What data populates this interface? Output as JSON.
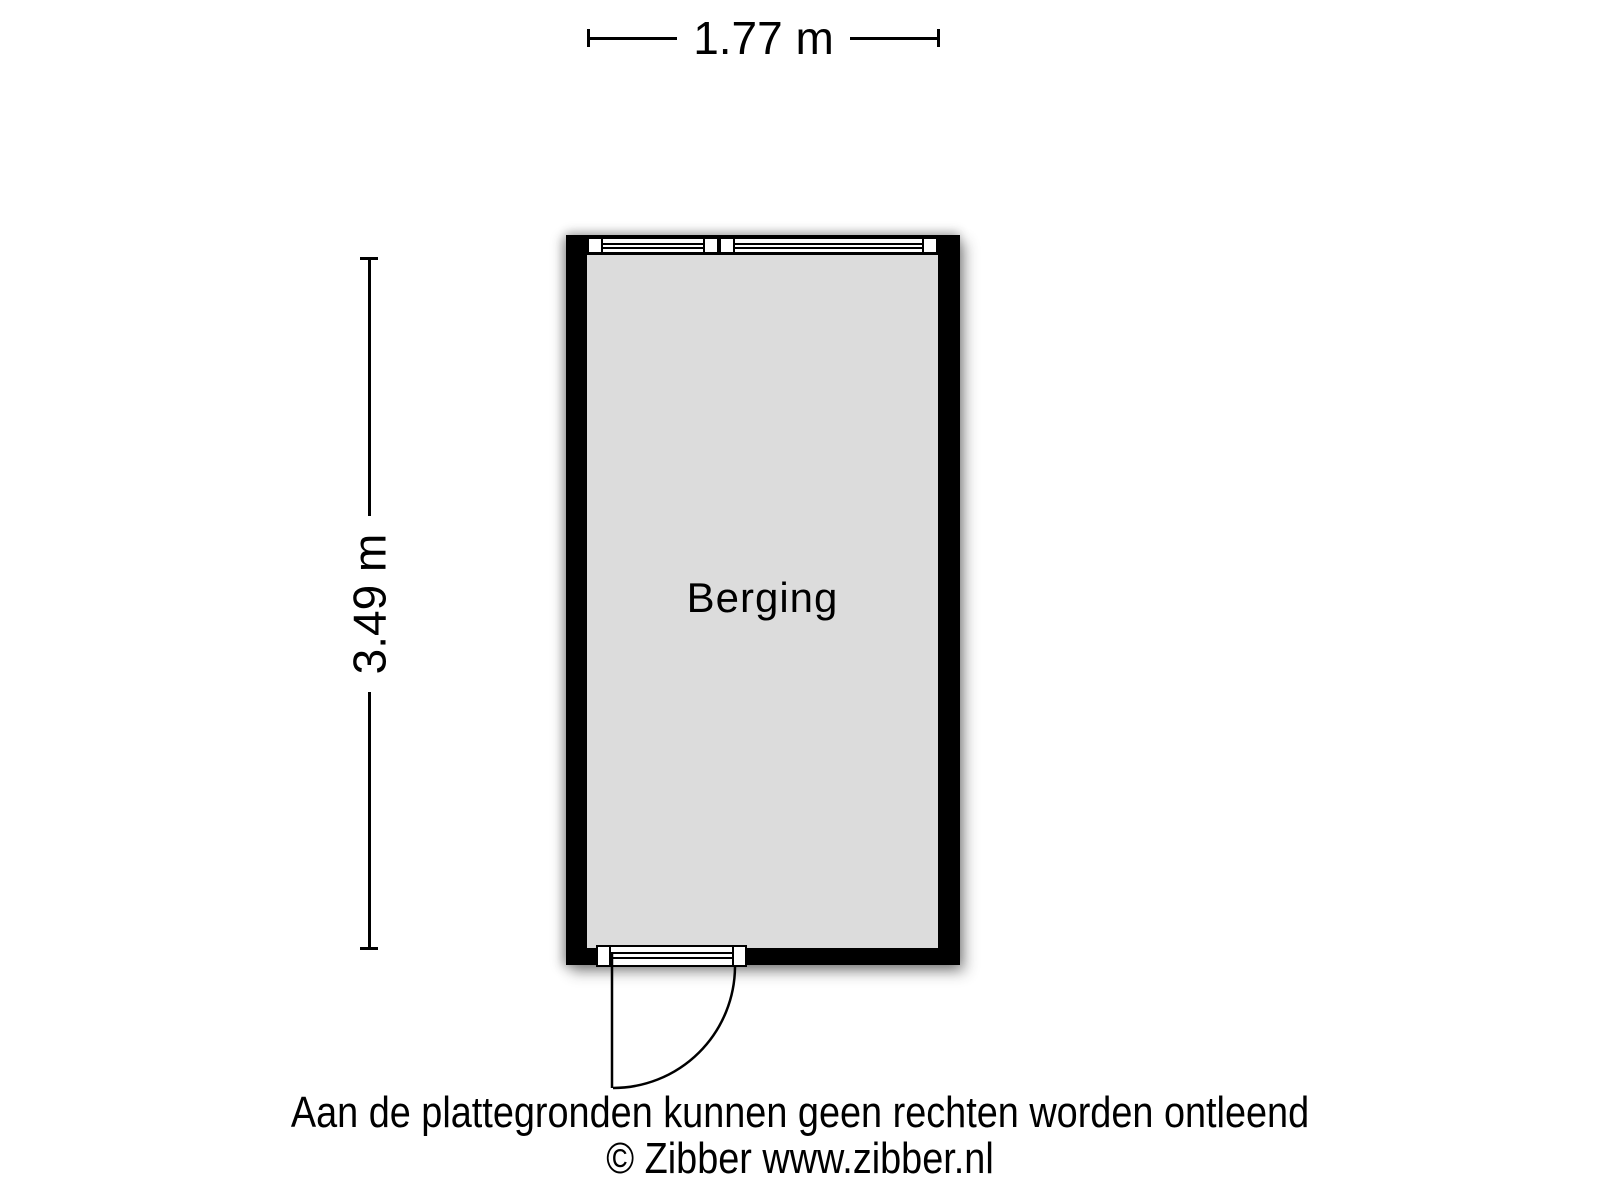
{
  "floorplan": {
    "room": {
      "label": "Berging",
      "fill": "#dcdcdc",
      "wall_color": "#000000"
    },
    "dimensions": {
      "width_label": "1.77 m",
      "height_label": "3.49 m"
    },
    "footer": {
      "disclaimer": "Aan de plattegronden kunnen geen rechten worden ontleend",
      "copyright": "© Zibber www.zibber.nl"
    },
    "colors": {
      "background": "#ffffff",
      "text": "#000000"
    }
  }
}
